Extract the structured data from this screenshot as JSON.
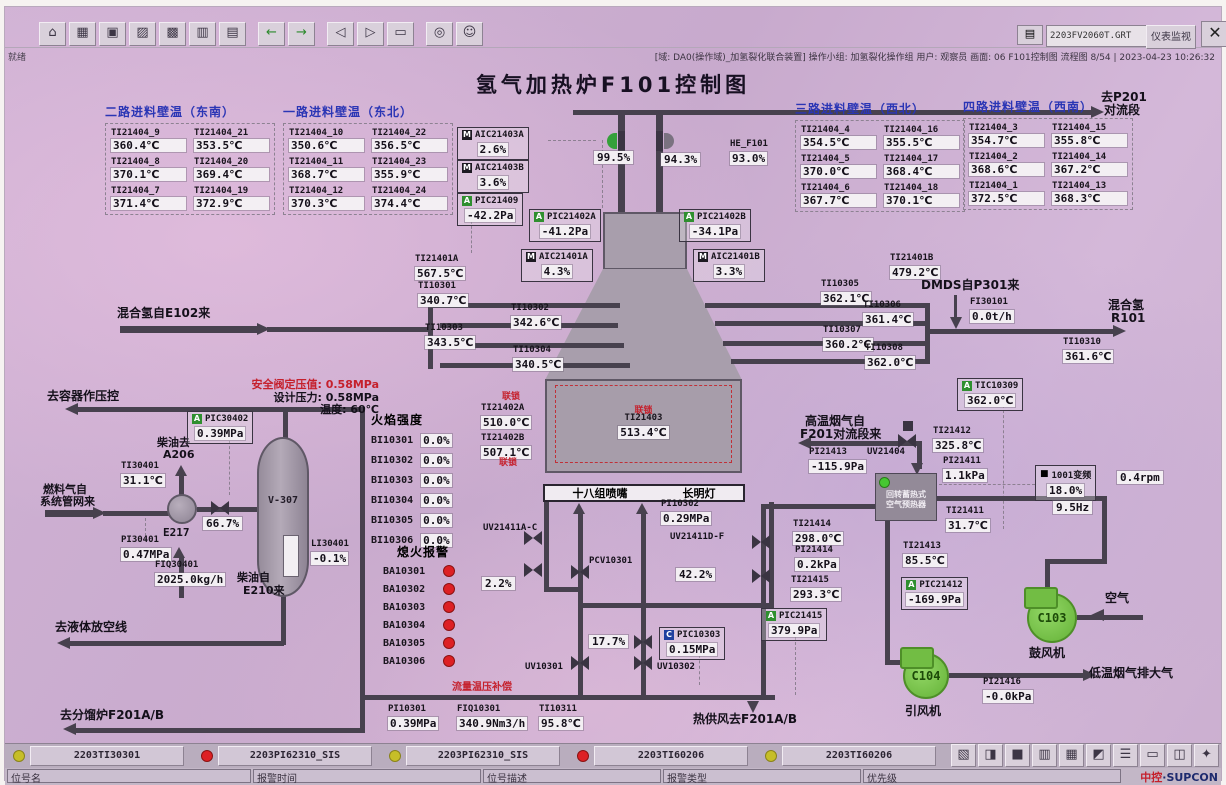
{
  "window": {
    "file_field": "2203FV2060T.GRT",
    "monitor_button": "仪表监视",
    "dropdown_glyph": "▾",
    "close_glyph": "✕",
    "printer_glyph": "▤",
    "status_left": "就绪",
    "status_right": "[域: DA0(操作域)_加氢裂化联合装置] 操作小组: 加氢裂化操作组  用户: 观察员  画面: 06 F101控制图  流程图 8/54 | 2023-04-23 10:26:32"
  },
  "title": "氢气加热炉F101控制图",
  "toolbar": {
    "icons": [
      {
        "name": "home",
        "glyph": "⌂"
      },
      {
        "name": "overview",
        "glyph": "▦"
      },
      {
        "name": "screen",
        "glyph": "▣"
      },
      {
        "name": "factory",
        "glyph": "▨"
      },
      {
        "name": "group",
        "glyph": "▩"
      },
      {
        "name": "trend",
        "glyph": "▥"
      },
      {
        "name": "report",
        "glyph": "▤"
      },
      {
        "name": "back",
        "glyph": "←"
      },
      {
        "name": "forward",
        "glyph": "→"
      },
      {
        "name": "page-prev",
        "glyph": "◁"
      },
      {
        "name": "page-next",
        "glyph": "▷"
      },
      {
        "name": "book",
        "glyph": "▭"
      },
      {
        "name": "search",
        "glyph": "◎"
      },
      {
        "name": "user",
        "glyph": "☺"
      }
    ]
  },
  "bottom_icons": [
    {
      "name": "snapshot",
      "glyph": "▧"
    },
    {
      "name": "lock",
      "glyph": "◨"
    },
    {
      "name": "screen",
      "glyph": "■"
    },
    {
      "name": "print",
      "glyph": "▥"
    },
    {
      "name": "calendar",
      "glyph": "▦"
    },
    {
      "name": "alarm",
      "glyph": "◩"
    },
    {
      "name": "list",
      "glyph": "☰"
    },
    {
      "name": "report",
      "glyph": "▭"
    },
    {
      "name": "window",
      "glyph": "◫"
    },
    {
      "name": "help",
      "glyph": "✦"
    }
  ],
  "wall_groups": [
    {
      "title": "二路进料壁温（东南）",
      "items": [
        {
          "id": "TI21404_9",
          "v": "360.4℃"
        },
        {
          "id": "TI21404_21",
          "v": "353.5℃"
        },
        {
          "id": "TI21404_8",
          "v": "370.1℃"
        },
        {
          "id": "TI21404_20",
          "v": "369.4℃"
        },
        {
          "id": "TI21404_7",
          "v": "371.4℃"
        },
        {
          "id": "TI21404_19",
          "v": "372.9℃"
        }
      ]
    },
    {
      "title": "一路进料壁温（东北）",
      "items": [
        {
          "id": "TI21404_10",
          "v": "350.6℃"
        },
        {
          "id": "TI21404_22",
          "v": "356.5℃"
        },
        {
          "id": "TI21404_11",
          "v": "368.7℃"
        },
        {
          "id": "TI21404_23",
          "v": "355.9℃"
        },
        {
          "id": "TI21404_12",
          "v": "370.3℃"
        },
        {
          "id": "TI21404_24",
          "v": "374.4℃"
        }
      ]
    },
    {
      "title": "三路进料壁温（西北）",
      "items": [
        {
          "id": "TI21404_4",
          "v": "354.5℃"
        },
        {
          "id": "TI21404_16",
          "v": "355.5℃"
        },
        {
          "id": "TI21404_5",
          "v": "370.0℃"
        },
        {
          "id": "TI21404_17",
          "v": "368.4℃"
        },
        {
          "id": "TI21404_6",
          "v": "367.7℃"
        },
        {
          "id": "TI21404_18",
          "v": "370.1℃"
        }
      ]
    },
    {
      "title": "四路进料壁温（西南）",
      "items": [
        {
          "id": "TI21404_3",
          "v": "354.7℃"
        },
        {
          "id": "TI21404_15",
          "v": "355.8℃"
        },
        {
          "id": "TI21404_2",
          "v": "368.6℃"
        },
        {
          "id": "TI21404_14",
          "v": "367.2℃"
        },
        {
          "id": "TI21404_1",
          "v": "372.5℃"
        },
        {
          "id": "TI21404_13",
          "v": "368.3℃"
        }
      ]
    }
  ],
  "tags": {
    "AIC21403A": {
      "b": "M",
      "id": "AIC21403A",
      "v": "2.6%"
    },
    "AIC21403B": {
      "b": "M",
      "id": "AIC21403B",
      "v": "3.6%"
    },
    "PIC21409": {
      "b": "A",
      "id": "PIC21409",
      "v": "-42.2Pa"
    },
    "PIC21402A": {
      "b": "A",
      "id": "PIC21402A",
      "v": "-41.2Pa"
    },
    "PIC21402B": {
      "b": "A",
      "id": "PIC21402B",
      "v": "-34.1Pa"
    },
    "AIC21401A": {
      "b": "M",
      "id": "AIC21401A",
      "v": "4.3%"
    },
    "AIC21401B": {
      "b": "M",
      "id": "AIC21401B",
      "v": "3.3%"
    },
    "HE_F101": {
      "id": "HE_F101",
      "v": "93.0%"
    },
    "TI21401A": {
      "id": "TI21401A",
      "v": "567.5℃"
    },
    "TI21401B": {
      "id": "TI21401B",
      "v": "479.2℃"
    },
    "TI10301": {
      "id": "TI10301",
      "v": "340.7℃"
    },
    "TI10302": {
      "id": "TI10302",
      "v": "342.6℃"
    },
    "TI10303": {
      "id": "TI10303",
      "v": "343.5℃"
    },
    "TI10304": {
      "id": "TI10304",
      "v": "340.5℃"
    },
    "TI10305": {
      "id": "TI10305",
      "v": "362.1℃"
    },
    "TI10306": {
      "id": "TI10306",
      "v": "361.4℃"
    },
    "TI10307": {
      "id": "TI10307",
      "v": "360.2℃"
    },
    "TI10308": {
      "id": "TI10308",
      "v": "362.0℃"
    },
    "TI10310": {
      "id": "TI10310",
      "v": "361.6℃"
    },
    "TIC10309": {
      "b": "A",
      "id": "TIC10309",
      "v": "362.0℃"
    },
    "FI30101": {
      "id": "FI30101",
      "v": "0.0t/h"
    },
    "TI21402A": {
      "id": "TI21402A",
      "v": "510.0℃"
    },
    "TI21402B": {
      "id": "TI21402B",
      "v": "507.1℃"
    },
    "TI21403": {
      "id": "TI21403",
      "v": "513.4℃"
    },
    "PI10302": {
      "id": "PI10302",
      "v": "0.29MPa"
    },
    "PIC10303": {
      "b": "C",
      "id": "PIC10303",
      "v": "0.15MPa"
    },
    "PI10301": {
      "id": "PI10301",
      "v": "0.39MPa"
    },
    "FIQ10301": {
      "id": "FIQ10301",
      "v": "340.9Nm3/h"
    },
    "TI10311": {
      "id": "TI10311",
      "v": "95.8℃"
    },
    "PIC30402": {
      "b": "A",
      "id": "PIC30402",
      "v": "0.39MPa"
    },
    "TI30401": {
      "id": "TI30401",
      "v": "31.1℃"
    },
    "PI30401": {
      "id": "PI30401",
      "v": "0.47MPa"
    },
    "FIQ30401": {
      "id": "FIQ30401",
      "v": "2025.0kg/h"
    },
    "LI30401": {
      "id": "LI30401",
      "v": "-0.1%"
    },
    "TI21412": {
      "id": "TI21412",
      "v": "325.8℃"
    },
    "PI21413": {
      "id": "PI21413",
      "v": "-115.9Pa"
    },
    "PI21411": {
      "id": "PI21411",
      "v": "1.1kPa"
    },
    "TI21411": {
      "id": "TI21411",
      "v": "31.7℃"
    },
    "TI21414": {
      "id": "TI21414",
      "v": "298.0℃"
    },
    "PI21414": {
      "id": "PI21414",
      "v": "0.2kPa"
    },
    "TI21415": {
      "id": "TI21415",
      "v": "293.3℃"
    },
    "TI21413": {
      "id": "TI21413",
      "v": "85.5℃"
    },
    "PIC21412": {
      "b": "A",
      "id": "PIC21412",
      "v": "-169.9Pa"
    },
    "PIC21415": {
      "b": "A",
      "id": "PIC21415",
      "v": "379.9Pa"
    },
    "PI21416": {
      "id": "PI21416",
      "v": "-0.0kPa"
    }
  },
  "valves": {
    "damper_a": "99.5%",
    "damper_b": "94.3%",
    "v667": "66.7%",
    "v22": "2.2%",
    "v422": "42.2%",
    "v177": "17.7%"
  },
  "motor": {
    "icon": "■",
    "label": "1001变频",
    "pct": "18.0%",
    "hz": "9.5Hz",
    "rpm": "0.4rpm"
  },
  "flame": {
    "title": "火焰强度",
    "rows": [
      {
        "id": "BI10301",
        "v": "0.0%"
      },
      {
        "id": "BI10302",
        "v": "0.0%"
      },
      {
        "id": "BI10303",
        "v": "0.0%"
      },
      {
        "id": "BI10304",
        "v": "0.0%"
      },
      {
        "id": "BI10305",
        "v": "0.0%"
      },
      {
        "id": "BI10306",
        "v": "0.0%"
      }
    ]
  },
  "flameout": {
    "title": "熄火报警",
    "rows": [
      "BA10301",
      "BA10302",
      "BA10303",
      "BA10304",
      "BA10305",
      "BA10306"
    ]
  },
  "labels": {
    "toP201a": "去P201",
    "toP201b": "对流段",
    "heIn": "混合氢自E102来",
    "dmds": "DMDS自P301来",
    "mixH2": "混合氢",
    "r101": "R101",
    "interlock": "联锁",
    "burners": "十八组喷嘴",
    "pilot": "长明灯",
    "toVessel": "去容器作压控",
    "psvNote": "安全阀定压值: 0.58MPa",
    "designP": "设计压力: 0.58MPa",
    "designT": "温度: 60℃",
    "dieselTo1": "柴油去",
    "dieselTo2": "A206",
    "fuelGas1": "燃料气自",
    "fuelGas2": "系统管网来",
    "dieselFrom1": "柴油自",
    "dieselFrom2": "E210来",
    "e217": "E217",
    "toVent": "去液体放空线",
    "toF201": "去分馏炉F201A/B",
    "hotFlue1": "高温烟气自",
    "hotFlue2": "F201对流段来",
    "uv21404": "UV21404",
    "preheat1": "回转蓄热式",
    "preheat2": "空气预热器",
    "blowerId": "C103",
    "blowerName": "鼓风机",
    "fanId": "C104",
    "fanName": "引风机",
    "air": "空气",
    "coldFlue": "低温烟气排大气",
    "hotAir": "热供风去F201A/B",
    "flowComp": "流量温压补偿",
    "pcv": "PCV10301",
    "uvAC": "UV21411A-C",
    "uvDF": "UV21411D-F",
    "uv10301": "UV10301",
    "uv10302": "UV10302"
  },
  "alarm_bar": {
    "entries": [
      {
        "tag": "2203TI30301",
        "color": "#c6be28"
      },
      {
        "tag": "2203PI62310_SIS",
        "color": "#e02020"
      },
      {
        "tag": "2203PI62310_SIS",
        "color": "#c6be28"
      },
      {
        "tag": "2203TI60206",
        "color": "#e02020"
      },
      {
        "tag": "2203TI60206",
        "color": "#c6be28"
      }
    ],
    "fields": [
      "位号名",
      "报警时间",
      "位号描述",
      "报警类型",
      "优先级"
    ],
    "brand_zk": "中控",
    "brand_sc": "·SUPCON"
  }
}
